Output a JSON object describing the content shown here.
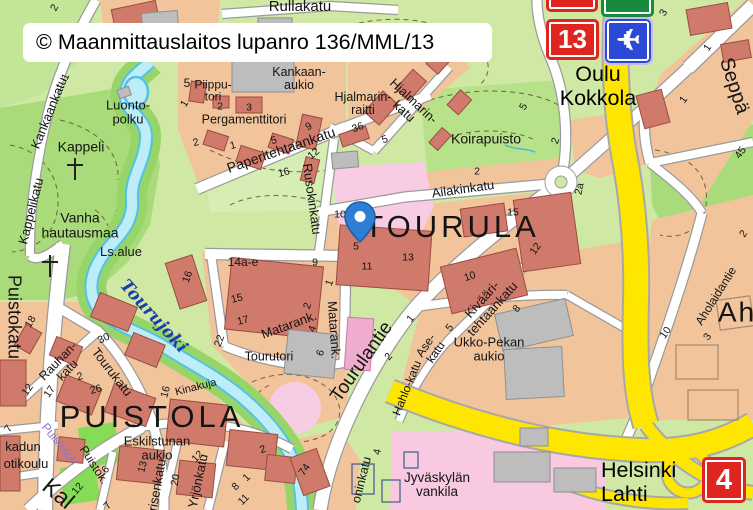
{
  "attribution": "© Maanmittauslaitos lupanro 136/MML/13",
  "signs": {
    "route_13": "13",
    "route_4": "4",
    "airplane": "✈"
  },
  "directions": {
    "north": "Oulu\nKokkola",
    "south": "Helsinki\nLahti"
  },
  "palette": {
    "park_green": "#aadc7c",
    "base_green": "#cfe8a4",
    "block_salmon": "#f2c49c",
    "building_red": "#cf7a6b",
    "building_gray": "#bdbdbd",
    "special_pink": "#f9c9e1",
    "water": "#bdeef8",
    "water_edge": "#54c2e6",
    "highway_yellow": "#ffe600",
    "sign_red": "#e02420",
    "sign_green": "#178a3e",
    "sign_blue": "#2b49d4",
    "marker_blue": "#2e7ed6",
    "river_label_blue": "#1c3fae",
    "square_violet": "#8a74d6"
  },
  "map_labels": [
    {
      "t": "TOURULA",
      "x": 452,
      "y": 227,
      "s": 31,
      "ls": 4,
      "n": "district-label-tourula"
    },
    {
      "t": "PUISTOLA",
      "x": 152,
      "y": 417,
      "s": 31,
      "ls": 4,
      "n": "district-label-puistola"
    },
    {
      "t": "Ah",
      "x": 737,
      "y": 312,
      "s": 28,
      "ls": 2,
      "n": "district-label-partial"
    },
    {
      "t": "Rullakatu",
      "x": 300,
      "y": 7,
      "s": 15
    },
    {
      "t": "Kankaankatu",
      "x": 49,
      "y": 113,
      "r": -68,
      "s": 13
    },
    {
      "t": "Luonto-\npolku",
      "x": 128,
      "y": 112,
      "s": 13
    },
    {
      "t": "Kappeli",
      "x": 81,
      "y": 147,
      "s": 14
    },
    {
      "t": "Kappelikatu",
      "x": 31,
      "y": 211,
      "r": -76,
      "s": 13
    },
    {
      "t": "Vanha\nhautausmaa",
      "x": 80,
      "y": 225,
      "s": 14
    },
    {
      "t": "Ls.alue",
      "x": 121,
      "y": 252,
      "s": 13
    },
    {
      "t": "Puistokatu",
      "x": 14,
      "y": 317,
      "r": 90,
      "s": 18
    },
    {
      "t": "5",
      "x": 187,
      "y": 83,
      "s": 12
    },
    {
      "t": "Piippu-\ntori",
      "x": 213,
      "y": 91,
      "s": 12
    },
    {
      "t": "Pergamenttitori",
      "x": 244,
      "y": 120,
      "s": 12.5
    },
    {
      "t": "Kankaan-\naukio",
      "x": 299,
      "y": 79,
      "s": 12.5
    },
    {
      "t": "Hjalmarin-\nraitti",
      "x": 363,
      "y": 104,
      "s": 12.5
    },
    {
      "t": "Hjalmarin-\nkatu",
      "x": 409,
      "y": 106,
      "r": 43,
      "s": 13
    },
    {
      "t": "Paperitehtaankatu",
      "x": 281,
      "y": 150,
      "r": -19,
      "s": 14
    },
    {
      "t": "Rusokinkatu",
      "x": 312,
      "y": 199,
      "r": 82,
      "s": 13
    },
    {
      "t": "Koirapuisto",
      "x": 486,
      "y": 139,
      "s": 14
    },
    {
      "t": "Ailakinkatu",
      "x": 463,
      "y": 189,
      "r": -8,
      "s": 13
    },
    {
      "t": "Tourulantie",
      "x": 362,
      "y": 362,
      "r": -55,
      "s": 19
    },
    {
      "t": "Matarank.",
      "x": 289,
      "y": 325,
      "r": -20,
      "s": 13
    },
    {
      "t": "Matarank.",
      "x": 334,
      "y": 330,
      "r": 86,
      "s": 13
    },
    {
      "t": "Tourutori",
      "x": 269,
      "y": 357,
      "s": 12.5
    },
    {
      "t": "14a-e",
      "x": 243,
      "y": 262,
      "s": 12
    },
    {
      "t": "Kinakuja",
      "x": 196,
      "y": 388,
      "r": -14,
      "s": 11
    },
    {
      "t": "Tourujoki",
      "x": 153,
      "y": 317,
      "r": 48,
      "s": 17,
      "c": "water",
      "n": "river-label"
    },
    {
      "t": "Eskilstunan\naukio",
      "x": 157,
      "y": 448,
      "s": 13
    },
    {
      "t": "kadun",
      "x": 23,
      "y": 447,
      "s": 13
    },
    {
      "t": "otikoulu",
      "x": 26,
      "y": 464,
      "s": 13
    },
    {
      "t": "Puistotori",
      "x": 60,
      "y": 444,
      "r": 50,
      "s": 12,
      "c": "violet"
    },
    {
      "t": "Puistok.",
      "x": 94,
      "y": 465,
      "r": 57,
      "s": 12
    },
    {
      "t": "Rauhan-\nkatu",
      "x": 63,
      "y": 366,
      "r": -46,
      "s": 12.5
    },
    {
      "t": "Tourukatu",
      "x": 112,
      "y": 372,
      "r": 52,
      "s": 13
    },
    {
      "t": "Yrjönkatu",
      "x": 198,
      "y": 481,
      "r": -78,
      "s": 13
    },
    {
      "t": "risenkatu",
      "x": 157,
      "y": 485,
      "r": -80,
      "s": 13
    },
    {
      "t": "Kivääri-\ntehtaankatu",
      "x": 487,
      "y": 304,
      "r": -48,
      "s": 13
    },
    {
      "t": "Ukko-Pekan\naukio",
      "x": 489,
      "y": 349,
      "s": 13
    },
    {
      "t": "Ase-\nkatu",
      "x": 431,
      "y": 349,
      "r": -56,
      "s": 12
    },
    {
      "t": "Hahlo-katu",
      "x": 407,
      "y": 388,
      "r": -68,
      "s": 12
    },
    {
      "t": "Jyväskylän\nvankila",
      "x": 437,
      "y": 485,
      "s": 13.5
    },
    {
      "t": "oninkatu",
      "x": 362,
      "y": 480,
      "r": -76,
      "s": 12.5
    },
    {
      "t": "Aholaidantie",
      "x": 716,
      "y": 296,
      "r": -58,
      "s": 12
    },
    {
      "t": "Seppä",
      "x": 734,
      "y": 86,
      "r": 72,
      "s": 20
    },
    {
      "t": "Kal",
      "x": 58,
      "y": 494,
      "r": 40,
      "s": 23
    },
    {
      "t": "1",
      "x": 185,
      "y": 104,
      "r": -60
    },
    {
      "t": "2",
      "x": 220,
      "y": 107
    },
    {
      "t": "3",
      "x": 249,
      "y": 108
    },
    {
      "t": "2",
      "x": 196,
      "y": 143,
      "r": -15
    },
    {
      "t": "1",
      "x": 233,
      "y": 146,
      "r": -15
    },
    {
      "t": "5",
      "x": 274,
      "y": 141,
      "r": -15
    },
    {
      "t": "9",
      "x": 309,
      "y": 127,
      "r": -30
    },
    {
      "t": "12",
      "x": 314,
      "y": 154,
      "r": -40
    },
    {
      "t": "16",
      "x": 284,
      "y": 173,
      "r": -15
    },
    {
      "t": "36",
      "x": 358,
      "y": 128,
      "r": -20
    },
    {
      "t": "5",
      "x": 385,
      "y": 140,
      "r": -20
    },
    {
      "t": "2",
      "x": 55,
      "y": 8,
      "r": -60
    },
    {
      "t": "1",
      "x": 66,
      "y": 77,
      "r": -65
    },
    {
      "t": "16",
      "x": 188,
      "y": 277,
      "r": -70
    },
    {
      "t": "15",
      "x": 237,
      "y": 299,
      "r": -14
    },
    {
      "t": "17",
      "x": 243,
      "y": 321,
      "r": -14
    },
    {
      "t": "22",
      "x": 220,
      "y": 341,
      "r": -70
    },
    {
      "t": "9",
      "x": 315,
      "y": 263
    },
    {
      "t": "1",
      "x": 330,
      "y": 283,
      "r": -70
    },
    {
      "t": "2",
      "x": 308,
      "y": 306,
      "r": -70
    },
    {
      "t": "4",
      "x": 313,
      "y": 329,
      "r": -70
    },
    {
      "t": "6",
      "x": 321,
      "y": 353,
      "r": -70
    },
    {
      "t": "10",
      "x": 340,
      "y": 215
    },
    {
      "t": "5",
      "x": 356,
      "y": 247
    },
    {
      "t": "11",
      "x": 367,
      "y": 267
    },
    {
      "t": "13",
      "x": 408,
      "y": 258
    },
    {
      "t": "10",
      "x": 470,
      "y": 277,
      "r": -18
    },
    {
      "t": "15",
      "x": 513,
      "y": 213
    },
    {
      "t": "12",
      "x": 536,
      "y": 249,
      "r": -55
    },
    {
      "t": "2",
      "x": 477,
      "y": 172
    },
    {
      "t": "1",
      "x": 411,
      "y": 319,
      "r": -50
    },
    {
      "t": "5",
      "x": 450,
      "y": 328,
      "r": -50
    },
    {
      "t": "8",
      "x": 517,
      "y": 309,
      "r": -50
    },
    {
      "t": "2",
      "x": 389,
      "y": 357,
      "r": -50
    },
    {
      "t": "74",
      "x": 305,
      "y": 470,
      "r": -55
    },
    {
      "t": "4",
      "x": 378,
      "y": 452,
      "r": -78
    },
    {
      "t": "2",
      "x": 263,
      "y": 450,
      "r": -20
    },
    {
      "t": "1",
      "x": 247,
      "y": 478,
      "r": -45
    },
    {
      "t": "18",
      "x": 31,
      "y": 322,
      "r": -60
    },
    {
      "t": "30",
      "x": 104,
      "y": 339,
      "r": -25
    },
    {
      "t": "2",
      "x": 80,
      "y": 377,
      "r": -15
    },
    {
      "t": "26",
      "x": 96,
      "y": 390,
      "r": -15
    },
    {
      "t": "16",
      "x": 166,
      "y": 392,
      "r": -75
    },
    {
      "t": "12",
      "x": 28,
      "y": 390,
      "r": -55
    },
    {
      "t": "17",
      "x": 50,
      "y": 392,
      "r": -55
    },
    {
      "t": "7",
      "x": 9,
      "y": 429,
      "r": -55
    },
    {
      "t": "12",
      "x": 78,
      "y": 489,
      "r": -50
    },
    {
      "t": "6",
      "x": 106,
      "y": 470,
      "r": -50
    },
    {
      "t": "13",
      "x": 143,
      "y": 467,
      "r": -75
    },
    {
      "t": "20",
      "x": 176,
      "y": 480,
      "r": -80
    },
    {
      "t": "12",
      "x": 198,
      "y": 457,
      "r": -45
    },
    {
      "t": "8",
      "x": 236,
      "y": 487,
      "r": -45
    },
    {
      "t": "11",
      "x": 244,
      "y": 500,
      "r": -45
    },
    {
      "t": "7",
      "x": 108,
      "y": 506,
      "r": -50
    },
    {
      "t": "2",
      "x": 556,
      "y": 141,
      "r": -70
    },
    {
      "t": "2a",
      "x": 580,
      "y": 189,
      "r": -78
    },
    {
      "t": "5",
      "x": 524,
      "y": 107,
      "r": -60
    },
    {
      "t": "3",
      "x": 664,
      "y": 13,
      "r": -60
    },
    {
      "t": "1",
      "x": 708,
      "y": 48,
      "r": -55
    },
    {
      "t": "1",
      "x": 684,
      "y": 100,
      "r": -55
    },
    {
      "t": "45",
      "x": 741,
      "y": 153,
      "r": -55
    },
    {
      "t": "2",
      "x": 744,
      "y": 234,
      "r": -55
    },
    {
      "t": "10",
      "x": 666,
      "y": 333,
      "r": -55
    },
    {
      "t": "3",
      "x": 708,
      "y": 337,
      "r": -55
    }
  ]
}
